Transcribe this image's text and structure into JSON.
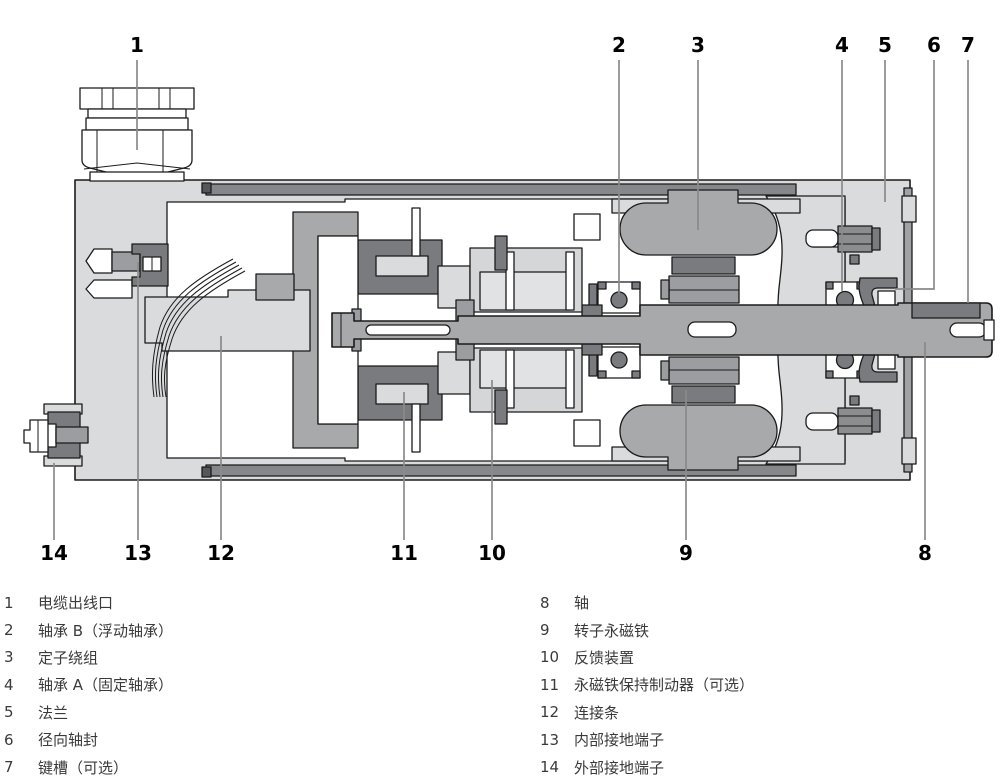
{
  "diagram": {
    "type": "servo-motor-longitudinal-cross-section",
    "colors": {
      "outline": "#1b1b1b",
      "housing_light_gray": "#d9dbdd",
      "component_mid_gray": "#a7a9ab",
      "component_dark_gray": "#797b7e",
      "leader_line_gray": "#8a8a8a",
      "label_black": "#000000",
      "legend_text": "#3a3a3a",
      "background": "#ffffff"
    },
    "callouts": [
      {
        "num": "1",
        "part": "电缆出线口",
        "lx": 137,
        "ly": 52,
        "pts": [
          [
            137,
            60
          ],
          [
            137,
            150
          ]
        ]
      },
      {
        "num": "2",
        "part": "轴承 B（浮动轴承）",
        "lx": 619,
        "ly": 52,
        "pts": [
          [
            619,
            60
          ],
          [
            619,
            294
          ]
        ]
      },
      {
        "num": "3",
        "part": "定子绕组",
        "lx": 698,
        "ly": 52,
        "pts": [
          [
            698,
            60
          ],
          [
            698,
            230
          ]
        ]
      },
      {
        "num": "4",
        "part": "轴承 A（固定轴承）",
        "lx": 842,
        "ly": 52,
        "pts": [
          [
            842,
            60
          ],
          [
            842,
            291
          ]
        ]
      },
      {
        "num": "5",
        "part": "法兰",
        "lx": 885,
        "ly": 52,
        "pts": [
          [
            885,
            60
          ],
          [
            885,
            202
          ]
        ]
      },
      {
        "num": "6",
        "part": "径向轴封",
        "lx": 934,
        "ly": 52,
        "pts": [
          [
            934,
            60
          ],
          [
            934,
            289
          ],
          [
            895,
            289
          ]
        ]
      },
      {
        "num": "7",
        "part": "键槽（可选）",
        "lx": 968,
        "ly": 52,
        "pts": [
          [
            968,
            60
          ],
          [
            968,
            303
          ]
        ]
      },
      {
        "num": "8",
        "part": "轴",
        "lx": 925,
        "ly": 560,
        "pts": [
          [
            925,
            540
          ],
          [
            925,
            342
          ]
        ]
      },
      {
        "num": "9",
        "part": "转子永磁铁",
        "lx": 686,
        "ly": 560,
        "pts": [
          [
            686,
            540
          ],
          [
            686,
            390
          ]
        ]
      },
      {
        "num": "10",
        "part": "反馈装置",
        "lx": 492,
        "ly": 560,
        "pts": [
          [
            492,
            540
          ],
          [
            492,
            380
          ]
        ]
      },
      {
        "num": "11",
        "part": "永磁铁保持制动器（可选）",
        "lx": 404,
        "ly": 560,
        "pts": [
          [
            404,
            540
          ],
          [
            404,
            392
          ]
        ]
      },
      {
        "num": "12",
        "part": "连接条",
        "lx": 221,
        "ly": 560,
        "pts": [
          [
            221,
            540
          ],
          [
            221,
            336
          ]
        ]
      },
      {
        "num": "13",
        "part": "内部接地端子",
        "lx": 138,
        "ly": 560,
        "pts": [
          [
            138,
            540
          ],
          [
            138,
            262
          ]
        ]
      },
      {
        "num": "14",
        "part": "外部接地端子",
        "lx": 54,
        "ly": 560,
        "pts": [
          [
            54,
            540
          ],
          [
            54,
            463
          ]
        ]
      }
    ]
  },
  "legend": {
    "left": [
      {
        "num": "1",
        "text": "电缆出线口"
      },
      {
        "num": "2",
        "text": "轴承 B（浮动轴承）"
      },
      {
        "num": "3",
        "text": "定子绕组"
      },
      {
        "num": "4",
        "text": "轴承 A（固定轴承）"
      },
      {
        "num": "5",
        "text": "法兰"
      },
      {
        "num": "6",
        "text": "径向轴封"
      },
      {
        "num": "7",
        "text": "键槽（可选）"
      }
    ],
    "right": [
      {
        "num": "8",
        "text": "轴"
      },
      {
        "num": "9",
        "text": "转子永磁铁"
      },
      {
        "num": "10",
        "text": "反馈装置"
      },
      {
        "num": "11",
        "text": "永磁铁保持制动器（可选）"
      },
      {
        "num": "12",
        "text": "连接条"
      },
      {
        "num": "13",
        "text": "内部接地端子"
      },
      {
        "num": "14",
        "text": "外部接地端子"
      }
    ]
  }
}
